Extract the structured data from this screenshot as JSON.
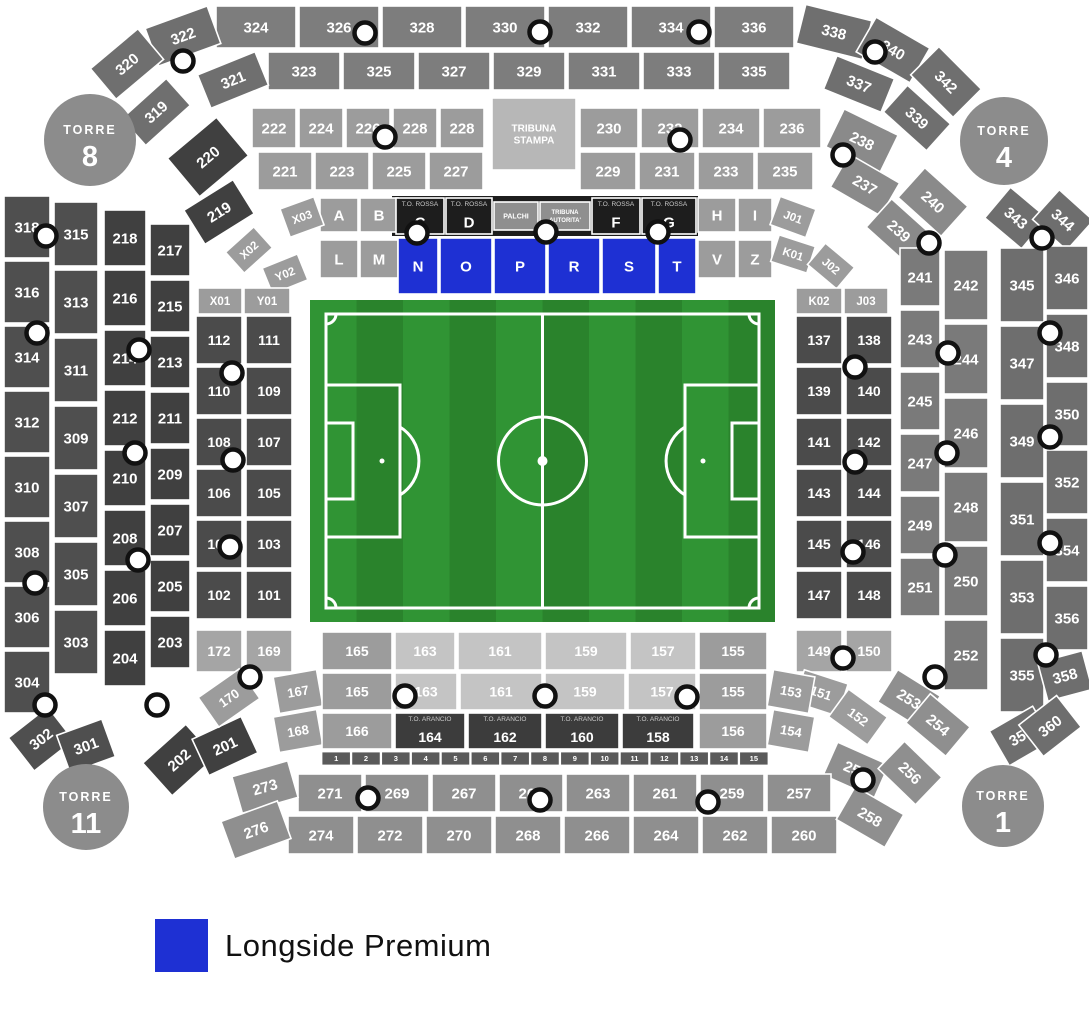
{
  "legend": {
    "swatch_color": "#1e30d3",
    "label": "Longside Premium"
  },
  "towers": [
    {
      "line1": "TORRE",
      "line2": "8"
    },
    {
      "line1": "TORRE",
      "line2": "4"
    },
    {
      "line1": "TORRE",
      "line2": "11"
    },
    {
      "line1": "TORRE",
      "line2": "1"
    }
  ],
  "icons": {
    "gate_marker": "white circle with dark ring"
  },
  "map": {
    "colors": {
      "outer_top": "#7d7d7d",
      "outer_ends": "#6f6f6f",
      "outer_left": "#4f4f4f",
      "outer_right": "#6e6e6e",
      "second_top": "#9c9c9c",
      "second_left": "#404040",
      "second_right": "#7a7a7a",
      "second_corner": "#8a8a8a",
      "second_bottom": "#8f8f8f",
      "inner_grey": "#9c9c9c",
      "inner_dark": "#4b4b4b",
      "inner_light": "#c4c4c4",
      "inner_med": "#9c9c9c",
      "inner_lightmed": "#a5a5a5",
      "black_band": "#1d1d1d",
      "palchi_box": "#8f8f8f",
      "arancio_box": "#3c3c3c",
      "stampa_box": "#b7b7b7",
      "strip": "#5a5a5a",
      "tower": "#8c8c8c",
      "premium_blue": "#1e30d3",
      "pitch_dark": "#2a832c",
      "pitch_light": "#309434",
      "marker_fill": "#ffffff",
      "marker_ring": "#111111"
    },
    "outer_top_row1": [
      "324",
      "326",
      "328",
      "330",
      "332",
      "334",
      "336"
    ],
    "outer_top_row1_left": [
      "322",
      "320"
    ],
    "outer_top_row1_right": [
      "338",
      "340",
      "342"
    ],
    "outer_top_row2": [
      "323",
      "325",
      "327",
      "329",
      "331",
      "333",
      "335"
    ],
    "outer_top_row2_left": [
      "321",
      "319"
    ],
    "outer_top_row2_right": [
      "337",
      "339"
    ],
    "outer_left_col1": [
      "318",
      "316",
      "314",
      "312",
      "310",
      "308",
      "306",
      "304"
    ],
    "outer_left_col2": [
      "315",
      "313",
      "311",
      "309",
      "307",
      "305",
      "303"
    ],
    "outer_left_bottom": [
      "302",
      "301"
    ],
    "outer_right_col_inner": [
      "343",
      "345",
      "347",
      "349",
      "351",
      "353",
      "355",
      "357"
    ],
    "outer_right_col_outer": [
      "344",
      "346",
      "348",
      "350",
      "352",
      "354",
      "356",
      "358",
      "360"
    ],
    "second_top_row1": [
      "222",
      "224",
      "226",
      "228",
      "228"
    ],
    "second_top_row1b": [
      "230",
      "232",
      "234",
      "236"
    ],
    "second_top_row2": [
      "221",
      "223",
      "225",
      "227"
    ],
    "second_top_row2b": [
      "229",
      "231",
      "233",
      "235"
    ],
    "second_top_left": [
      "220",
      "219"
    ],
    "second_top_right": [
      "238",
      "237",
      "240",
      "239"
    ],
    "second_left_col1": [
      "218",
      "216",
      "214",
      "212",
      "210",
      "208",
      "206",
      "204"
    ],
    "second_left_col2": [
      "217",
      "215",
      "213",
      "211",
      "209",
      "207",
      "205",
      "203"
    ],
    "second_left_bottom": [
      "202",
      "201"
    ],
    "second_right_col_inner": [
      "241",
      "243",
      "245",
      "247",
      "249",
      "251"
    ],
    "second_right_col_outer": [
      "242",
      "244",
      "246",
      "248",
      "250",
      "252"
    ],
    "second_right_bottom": [
      "253",
      "254",
      "255",
      "256"
    ],
    "second_bottom_row1": [
      "271",
      "269",
      "267",
      "265",
      "263",
      "261",
      "259",
      "257"
    ],
    "second_bottom_row1_left": [
      "273"
    ],
    "second_bottom_row2": [
      "274",
      "272",
      "270",
      "268",
      "266",
      "264",
      "262",
      "260"
    ],
    "second_bottom_row2_left": [
      "276"
    ],
    "second_bottom_row2_right": [
      "258"
    ],
    "tribuna_stampa_lines": [
      "TRIBUNA",
      "STAMPA"
    ],
    "inner_top_row1": [
      {
        "label": "A",
        "type": "grey"
      },
      {
        "label": "B",
        "type": "grey"
      },
      {
        "label": "C",
        "type": "rossa",
        "caption": "T.O. ROSSA"
      },
      {
        "label": "D",
        "type": "rossa",
        "caption": "T.O. ROSSA"
      },
      {
        "label": "PALCHI",
        "type": "palchi"
      },
      {
        "label": "TRIBUNA AUTORITA'",
        "type": "palchi",
        "lines": [
          "TRIBUNA",
          "AUTORITA'"
        ]
      },
      {
        "label": "F",
        "type": "rossa",
        "caption": "T.O. ROSSA"
      },
      {
        "label": "G",
        "type": "rossa",
        "caption": "T.O. ROSSA"
      },
      {
        "label": "H",
        "type": "grey"
      },
      {
        "label": "I",
        "type": "grey"
      }
    ],
    "inner_top_row2": [
      {
        "label": "L",
        "type": "grey"
      },
      {
        "label": "M",
        "type": "grey"
      },
      {
        "label": "N",
        "type": "blue"
      },
      {
        "label": "O",
        "type": "blue"
      },
      {
        "label": "P",
        "type": "blue"
      },
      {
        "label": "R",
        "type": "blue"
      },
      {
        "label": "S",
        "type": "blue"
      },
      {
        "label": "T",
        "type": "blue"
      },
      {
        "label": "V",
        "type": "grey"
      },
      {
        "label": "Z",
        "type": "grey"
      }
    ],
    "premium_sections": [
      "N",
      "O",
      "P",
      "R",
      "S",
      "T"
    ],
    "inner_corners_left": [
      "X03",
      "X02",
      "Y02"
    ],
    "inner_corners_right": [
      "J01",
      "K01",
      "J02"
    ],
    "inner_header_left": [
      "X01",
      "Y01"
    ],
    "inner_header_right": [
      "K02",
      "J03"
    ],
    "inner_left_col1": [
      "112",
      "110",
      "108",
      "106",
      "104",
      "102"
    ],
    "inner_left_col2": [
      "111",
      "109",
      "107",
      "105",
      "103",
      "101"
    ],
    "inner_left_light": [
      "172",
      "169"
    ],
    "inner_left_curve": [
      "170",
      "167",
      "168"
    ],
    "inner_right_col1": [
      "137",
      "139",
      "141",
      "143",
      "145",
      "147"
    ],
    "inner_right_col2": [
      "138",
      "140",
      "142",
      "144",
      "146",
      "148"
    ],
    "inner_right_light": [
      "149",
      "150"
    ],
    "inner_right_curve": [
      "151",
      "152",
      "153",
      "154"
    ],
    "bottom_rowA": [
      {
        "label": "165",
        "type": "med"
      },
      {
        "label": "163",
        "type": "light"
      },
      {
        "label": "161",
        "type": "light"
      },
      {
        "label": "159",
        "type": "light"
      },
      {
        "label": "157",
        "type": "light"
      },
      {
        "label": "155",
        "type": "med"
      }
    ],
    "bottom_rowB": [
      {
        "label": "165",
        "type": "med"
      },
      {
        "label": "163",
        "type": "light"
      },
      {
        "label": "161",
        "type": "light"
      },
      {
        "label": "159",
        "type": "light"
      },
      {
        "label": "157",
        "type": "light"
      },
      {
        "label": "155",
        "type": "med"
      }
    ],
    "bottom_rowC": [
      {
        "label": "166",
        "type": "med"
      },
      {
        "label": "164",
        "type": "arancio",
        "caption": "T.O. ARANCIO"
      },
      {
        "label": "162",
        "type": "arancio",
        "caption": "T.O. ARANCIO"
      },
      {
        "label": "160",
        "type": "arancio",
        "caption": "T.O. ARANCIO"
      },
      {
        "label": "158",
        "type": "arancio",
        "caption": "T.O. ARANCIO"
      },
      {
        "label": "156",
        "type": "med"
      }
    ],
    "bottom_strip": [
      "1",
      "2",
      "3",
      "4",
      "5",
      "6",
      "7",
      "8",
      "9",
      "10",
      "11",
      "12",
      "13",
      "14",
      "15"
    ]
  }
}
